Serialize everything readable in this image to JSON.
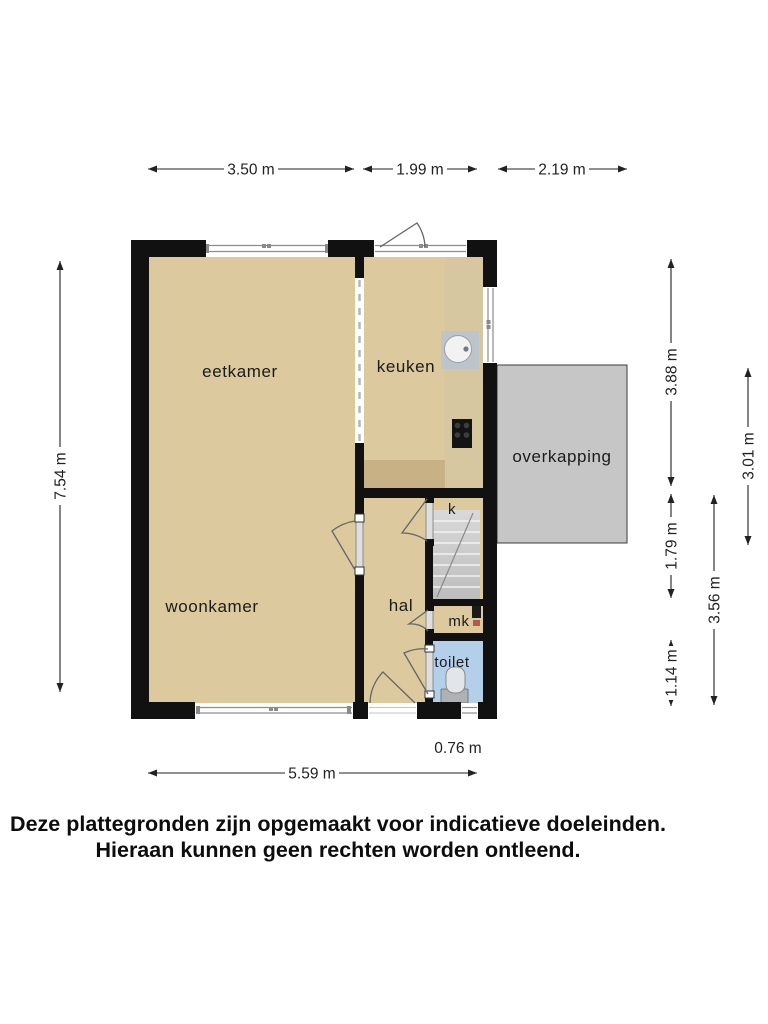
{
  "rooms": {
    "eetkamer": "eetkamer",
    "keuken": "keuken",
    "woonkamer": "woonkamer",
    "hal": "hal",
    "k": "k",
    "mk": "mk",
    "toilet": "toilet",
    "overkapping": "overkapping"
  },
  "dimensions": {
    "top": [
      "3.50 m",
      "1.99 m",
      "2.19 m"
    ],
    "left": "7.54 m",
    "right_inner": [
      "3.88 m",
      "1.79 m",
      "1.14 m"
    ],
    "right_outer": [
      "3.56 m",
      "3.01 m"
    ],
    "bottom": "5.59 m",
    "bottom_right": "0.76 m"
  },
  "disclaimer": {
    "line1": "Deze plattegronden zijn opgemaakt voor indicatieve doeleinden.",
    "line2": "Hieraan kunnen geen rechten worden ontleend."
  },
  "colors": {
    "wall": "#111111",
    "floor": "#dcc99d",
    "counter_light": "#d7c7a0",
    "counter_dark": "#c8b184",
    "stairs": "#c9c9c9",
    "toilet_floor": "#b4cfe9",
    "overkapping": "#c6c6c6",
    "frame": "#8d8d8d",
    "arc": "#666666",
    "dim": "#222222",
    "label": "#1b1b1b",
    "sink": "#bdc4cb",
    "stove": "#141414"
  }
}
